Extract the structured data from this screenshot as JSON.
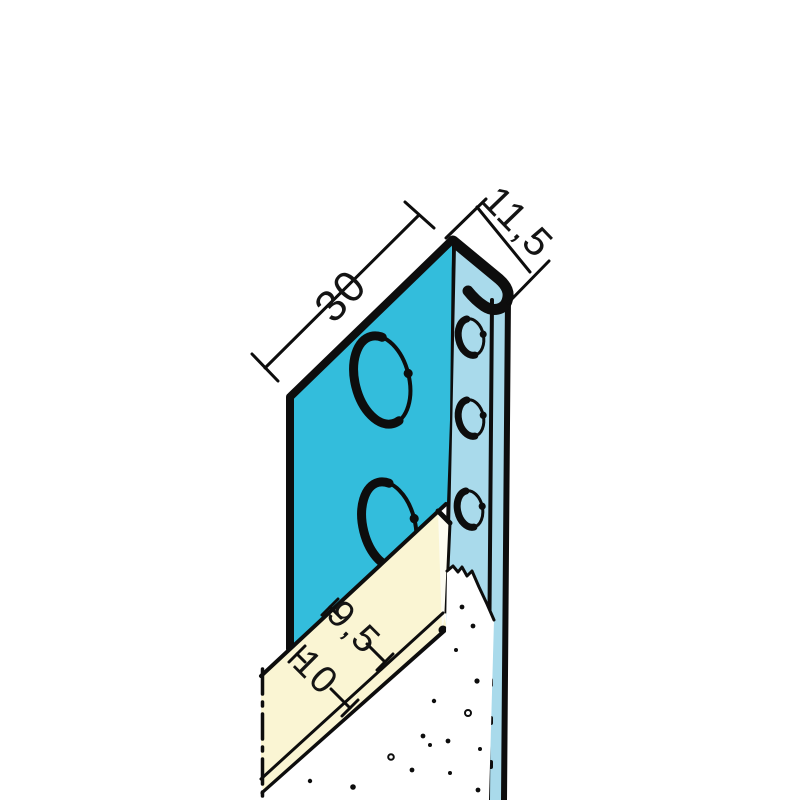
{
  "labels": {
    "flange_width": "30",
    "edge_depth": "11,5",
    "board_thickness": "9,5",
    "channel_depth": "10"
  },
  "colors": {
    "background": "#ffffff",
    "flange": "#33bddc",
    "web": "#a9daeb",
    "board": "#faf5d3",
    "board_end": "#fdfcf1",
    "plaster": "#ffffff",
    "line": "#0d0d0d"
  }
}
